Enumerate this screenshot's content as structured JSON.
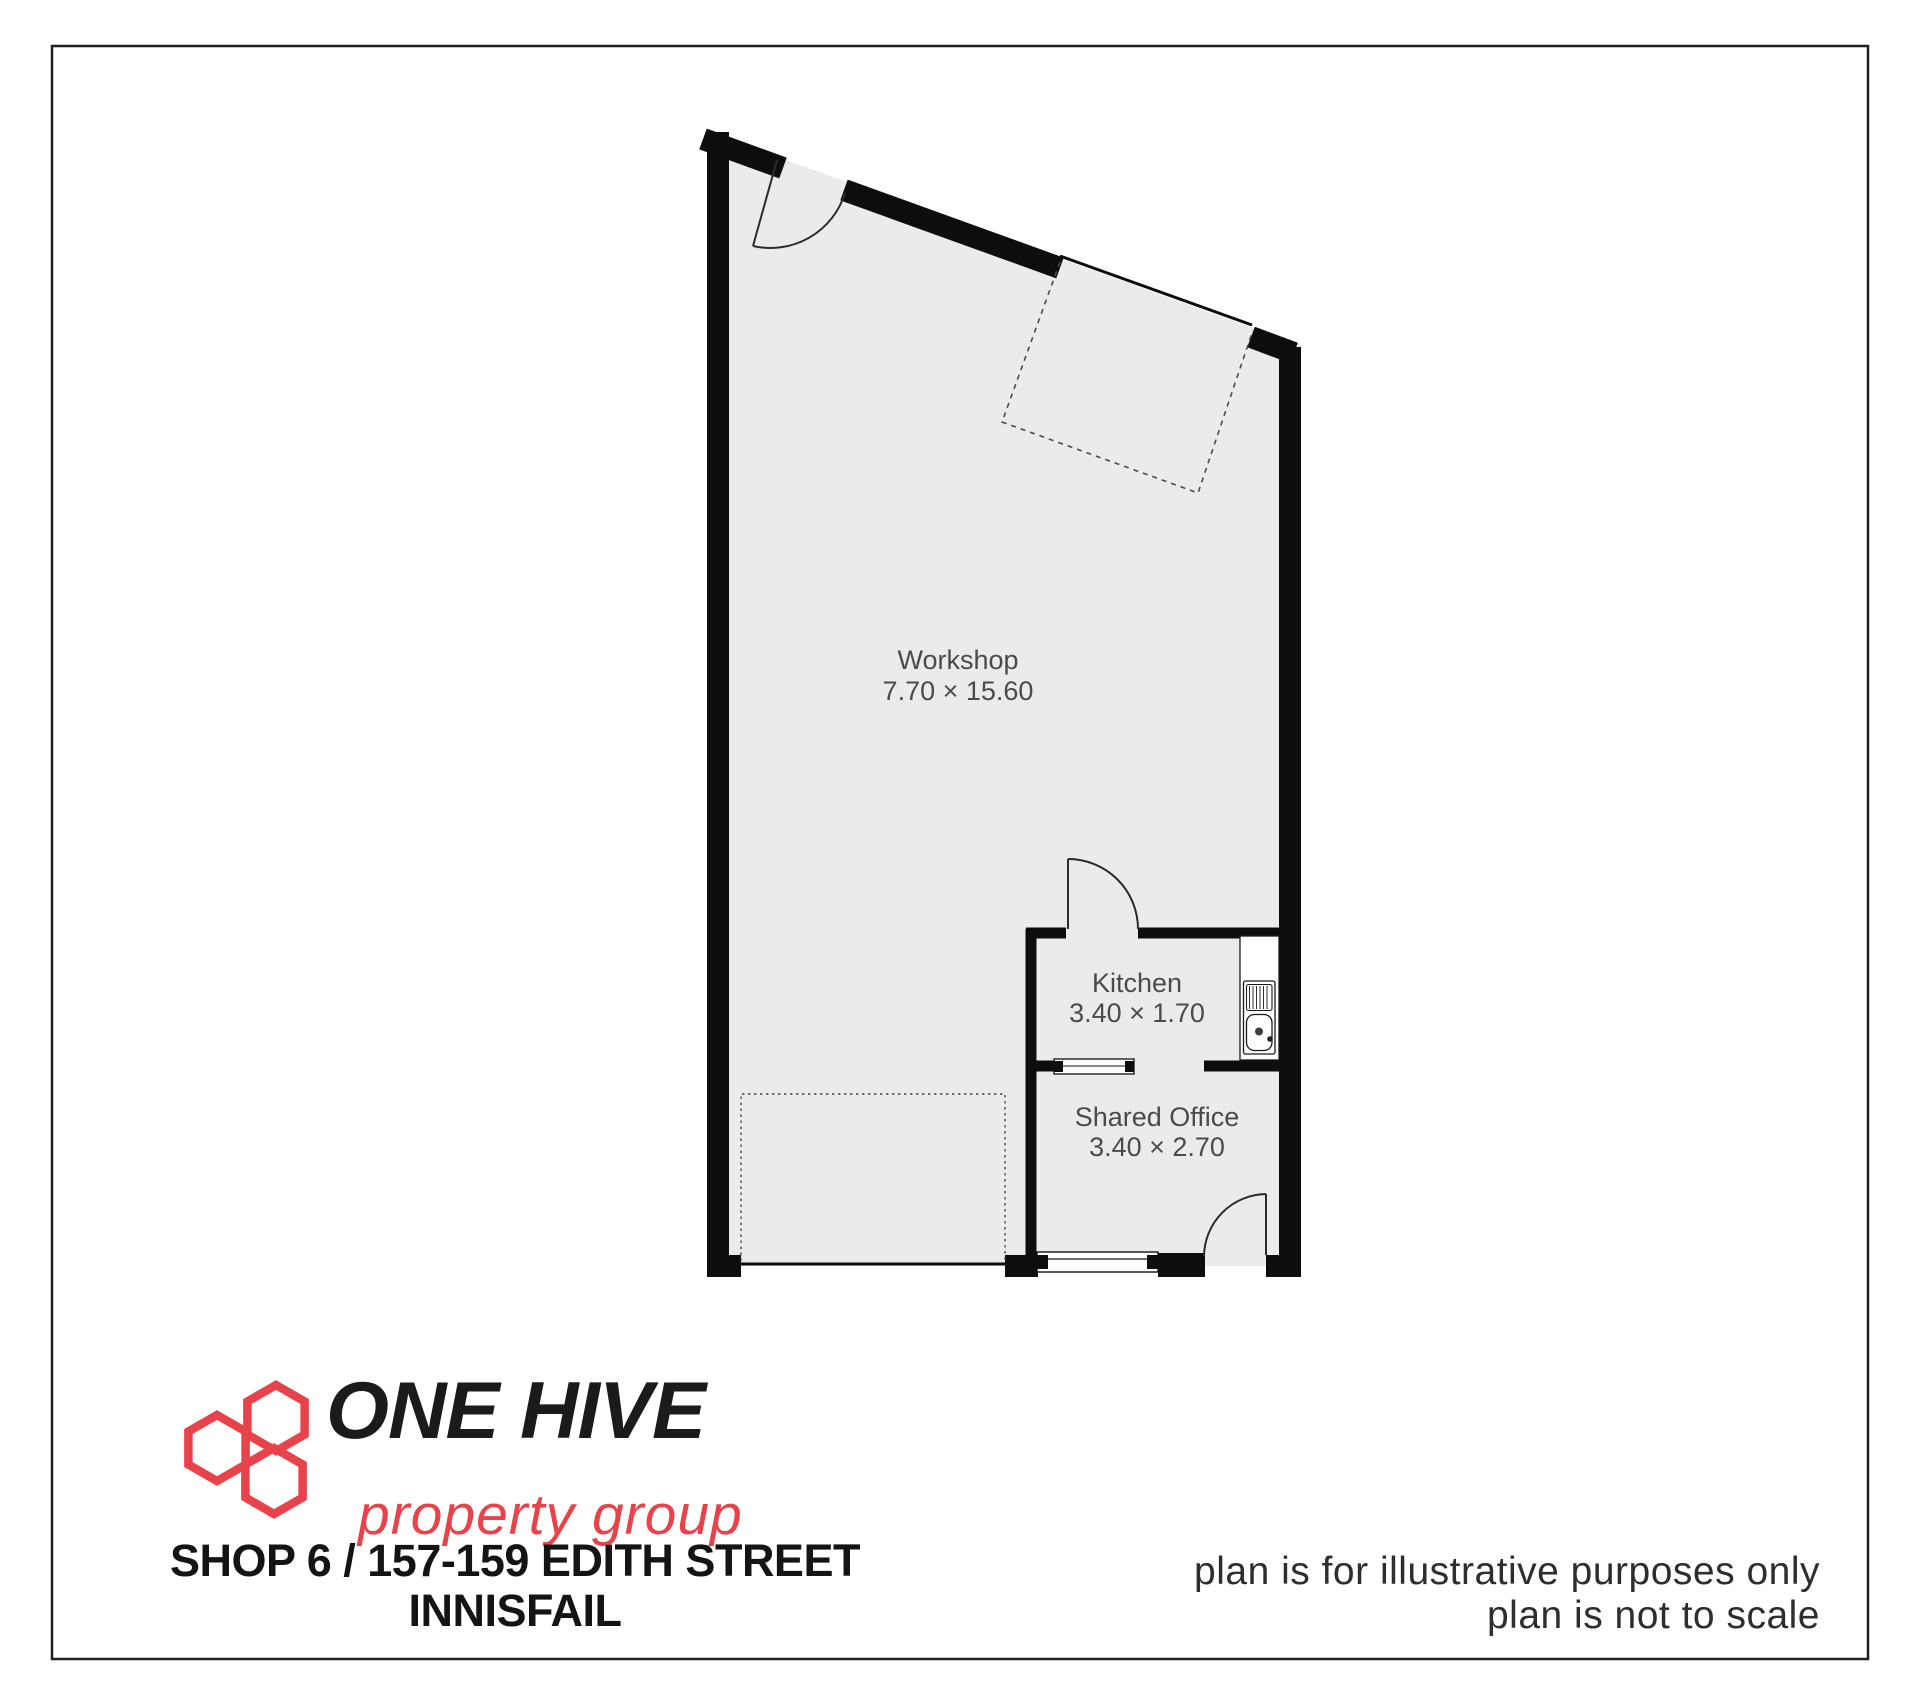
{
  "document": {
    "background_color": "#ffffff",
    "border_color": "#1f1f1f"
  },
  "floor_plan": {
    "floor_color": "#ebebeb",
    "wall_color": "#0d0d0d",
    "label_color": "#4b4b4b",
    "rooms": [
      {
        "name": "Workshop",
        "dimensions": "7.70 × 15.60"
      },
      {
        "name": "Kitchen",
        "dimensions": "3.40 × 1.70"
      },
      {
        "name": "Shared Office",
        "dimensions": "3.40 × 2.70"
      }
    ],
    "fixtures": [
      {
        "icon": "sink-icon",
        "location": "Kitchen"
      }
    ],
    "symbols": [
      "door-swing",
      "window-symbol",
      "roller-door-opening",
      "dashed-door-projection"
    ]
  },
  "branding": {
    "logo_icon": "honeycomb-logo-icon",
    "logo_line1": "ONE HIVE",
    "logo_line2": "property group",
    "logo_accent_color": "#e8434a",
    "logo_text_color": "#1b1b1b"
  },
  "address": {
    "line1": "SHOP 6 / 157-159 EDITH STREET",
    "line2": "INNISFAIL"
  },
  "disclaimer": {
    "line1": "plan is for illustrative purposes only",
    "line2": "plan is not to scale"
  }
}
